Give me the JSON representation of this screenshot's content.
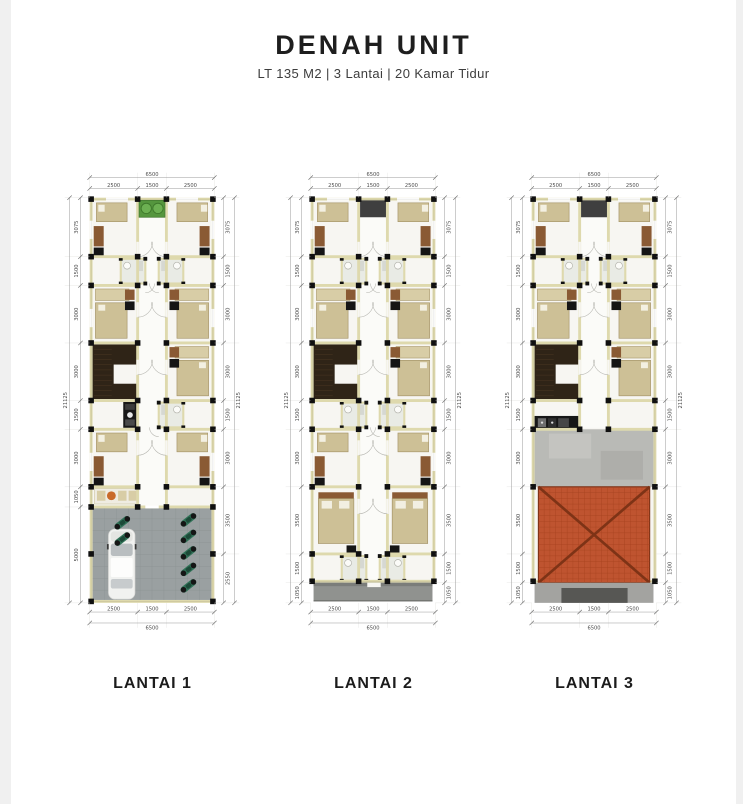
{
  "header": {
    "title": "DENAH UNIT",
    "subtitle": "LT 135 M2 | 3 Lantai | 20 Kamar Tidur"
  },
  "colors": {
    "wall": "#ded9ad",
    "wall_edge": "#bcb790",
    "floor_bg": "#f7f6f2",
    "corridor": "#fbfbf8",
    "bed": "#cdc096",
    "bed_border": "#a59468",
    "bed_strip": "#d8cda6",
    "desk": "#8a5a34",
    "wardrobe": "#151515",
    "stair": "#2f2417",
    "garden": "#55963e",
    "bush": "#6cb052",
    "void_dark": "#3f3f3f",
    "garage_floor": "#9aa0a1",
    "garage_line": "#8b9192",
    "car": "#f1f2f0",
    "moto": "#317258",
    "concrete": "#b9bab6",
    "roof": "#bf5430",
    "roof_grid": "#a6431f",
    "roof_hip": "#7e3316",
    "balcony": "#90928f",
    "strip_light": "#a3a3a0",
    "strip_dark": "#575754",
    "stove": "#c96a2a",
    "dim_line": "#9b9b9b",
    "dim_text": "#4c4c4c"
  },
  "floors": [
    {
      "id": "lantai-1",
      "label": "LANTAI 1",
      "type": "garage",
      "dims": {
        "top": {
          "segments": [
            "2500",
            "1500",
            "2500"
          ],
          "total": "6500"
        },
        "bottom": {
          "segments": [
            "2500",
            "1500",
            "2500"
          ],
          "total": "6500"
        },
        "left": {
          "segments": [
            "3075",
            "1500",
            "3000",
            "3000",
            "1500",
            "3000",
            "1050",
            "5000"
          ],
          "total": "21125"
        },
        "right": {
          "segments": [
            "3075",
            "1500",
            "3000",
            "3000",
            "1500",
            "3000",
            "3500",
            "2550"
          ],
          "total": "21125"
        }
      }
    },
    {
      "id": "lantai-2",
      "label": "LANTAI 2",
      "type": "bedrooms",
      "dims": {
        "top": {
          "segments": [
            "2500",
            "1500",
            "2500"
          ],
          "total": "6500"
        },
        "bottom": {
          "segments": [
            "2500",
            "1500",
            "2500"
          ],
          "total": "6500"
        },
        "left": {
          "segments": [
            "3075",
            "1500",
            "3000",
            "3000",
            "1500",
            "3000",
            "3500",
            "1500",
            "1050"
          ],
          "total": "21125"
        },
        "right": {
          "segments": [
            "3075",
            "1500",
            "3000",
            "3000",
            "1500",
            "3000",
            "3500",
            "1500",
            "1050"
          ],
          "total": "21125"
        }
      }
    },
    {
      "id": "lantai-3",
      "label": "LANTAI 3",
      "type": "roof",
      "dims": {
        "top": {
          "segments": [
            "2500",
            "1500",
            "2500"
          ],
          "total": "6500"
        },
        "bottom": {
          "segments": [
            "2500",
            "1500",
            "2500"
          ],
          "total": "6500"
        },
        "left": {
          "segments": [
            "3075",
            "1500",
            "3000",
            "3000",
            "1500",
            "3000",
            "3500",
            "1500",
            "1050"
          ],
          "total": "21125"
        },
        "right": {
          "segments": [
            "3075",
            "1500",
            "3000",
            "3000",
            "1500",
            "3000",
            "3500",
            "1500",
            "1050"
          ],
          "total": "21125"
        }
      }
    }
  ]
}
